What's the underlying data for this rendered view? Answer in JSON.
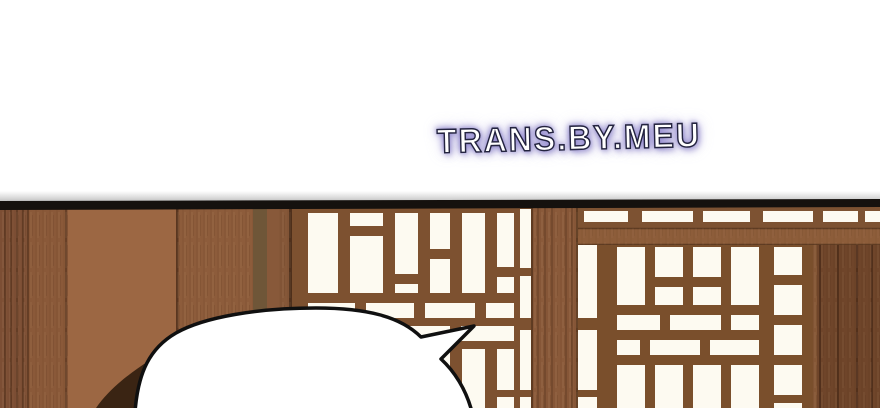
{
  "watermark": {
    "text": "TRANS.BY.MEU"
  },
  "palette": {
    "page_bg": "#ffffff",
    "ceiling_beam_black": "#15110e",
    "wall_plank_left": "#7f5136",
    "wall_plank_left2": "#8a5939",
    "wall_panel_smooth": "#9c6743",
    "wall_panel_textured": "#8d5c3b",
    "wall_strip_olive": "#6f5638",
    "wall_strip_mid": "#88593a",
    "wall_strip_end": "#855738",
    "center_post": "#8a5a3a",
    "lattice_wood_left": "#7d5130",
    "lattice_wood_right": "#7a4f2c",
    "lattice_opening": "#fdfaf1",
    "transom_wall": "#7d5232",
    "transom_beam": "#8d5d3a",
    "beam_edge": "#5f3c22",
    "right_planks": "#6f452a",
    "right_plank_highlight": "#8a5a38",
    "plank_seam": "#4a2b18",
    "bubble_fill": "#ffffff",
    "bubble_stroke": "#101010",
    "shadow_wedge": "#3a2413",
    "watermark_outline": "#23233f",
    "watermark_glow": "#8c82c8"
  }
}
